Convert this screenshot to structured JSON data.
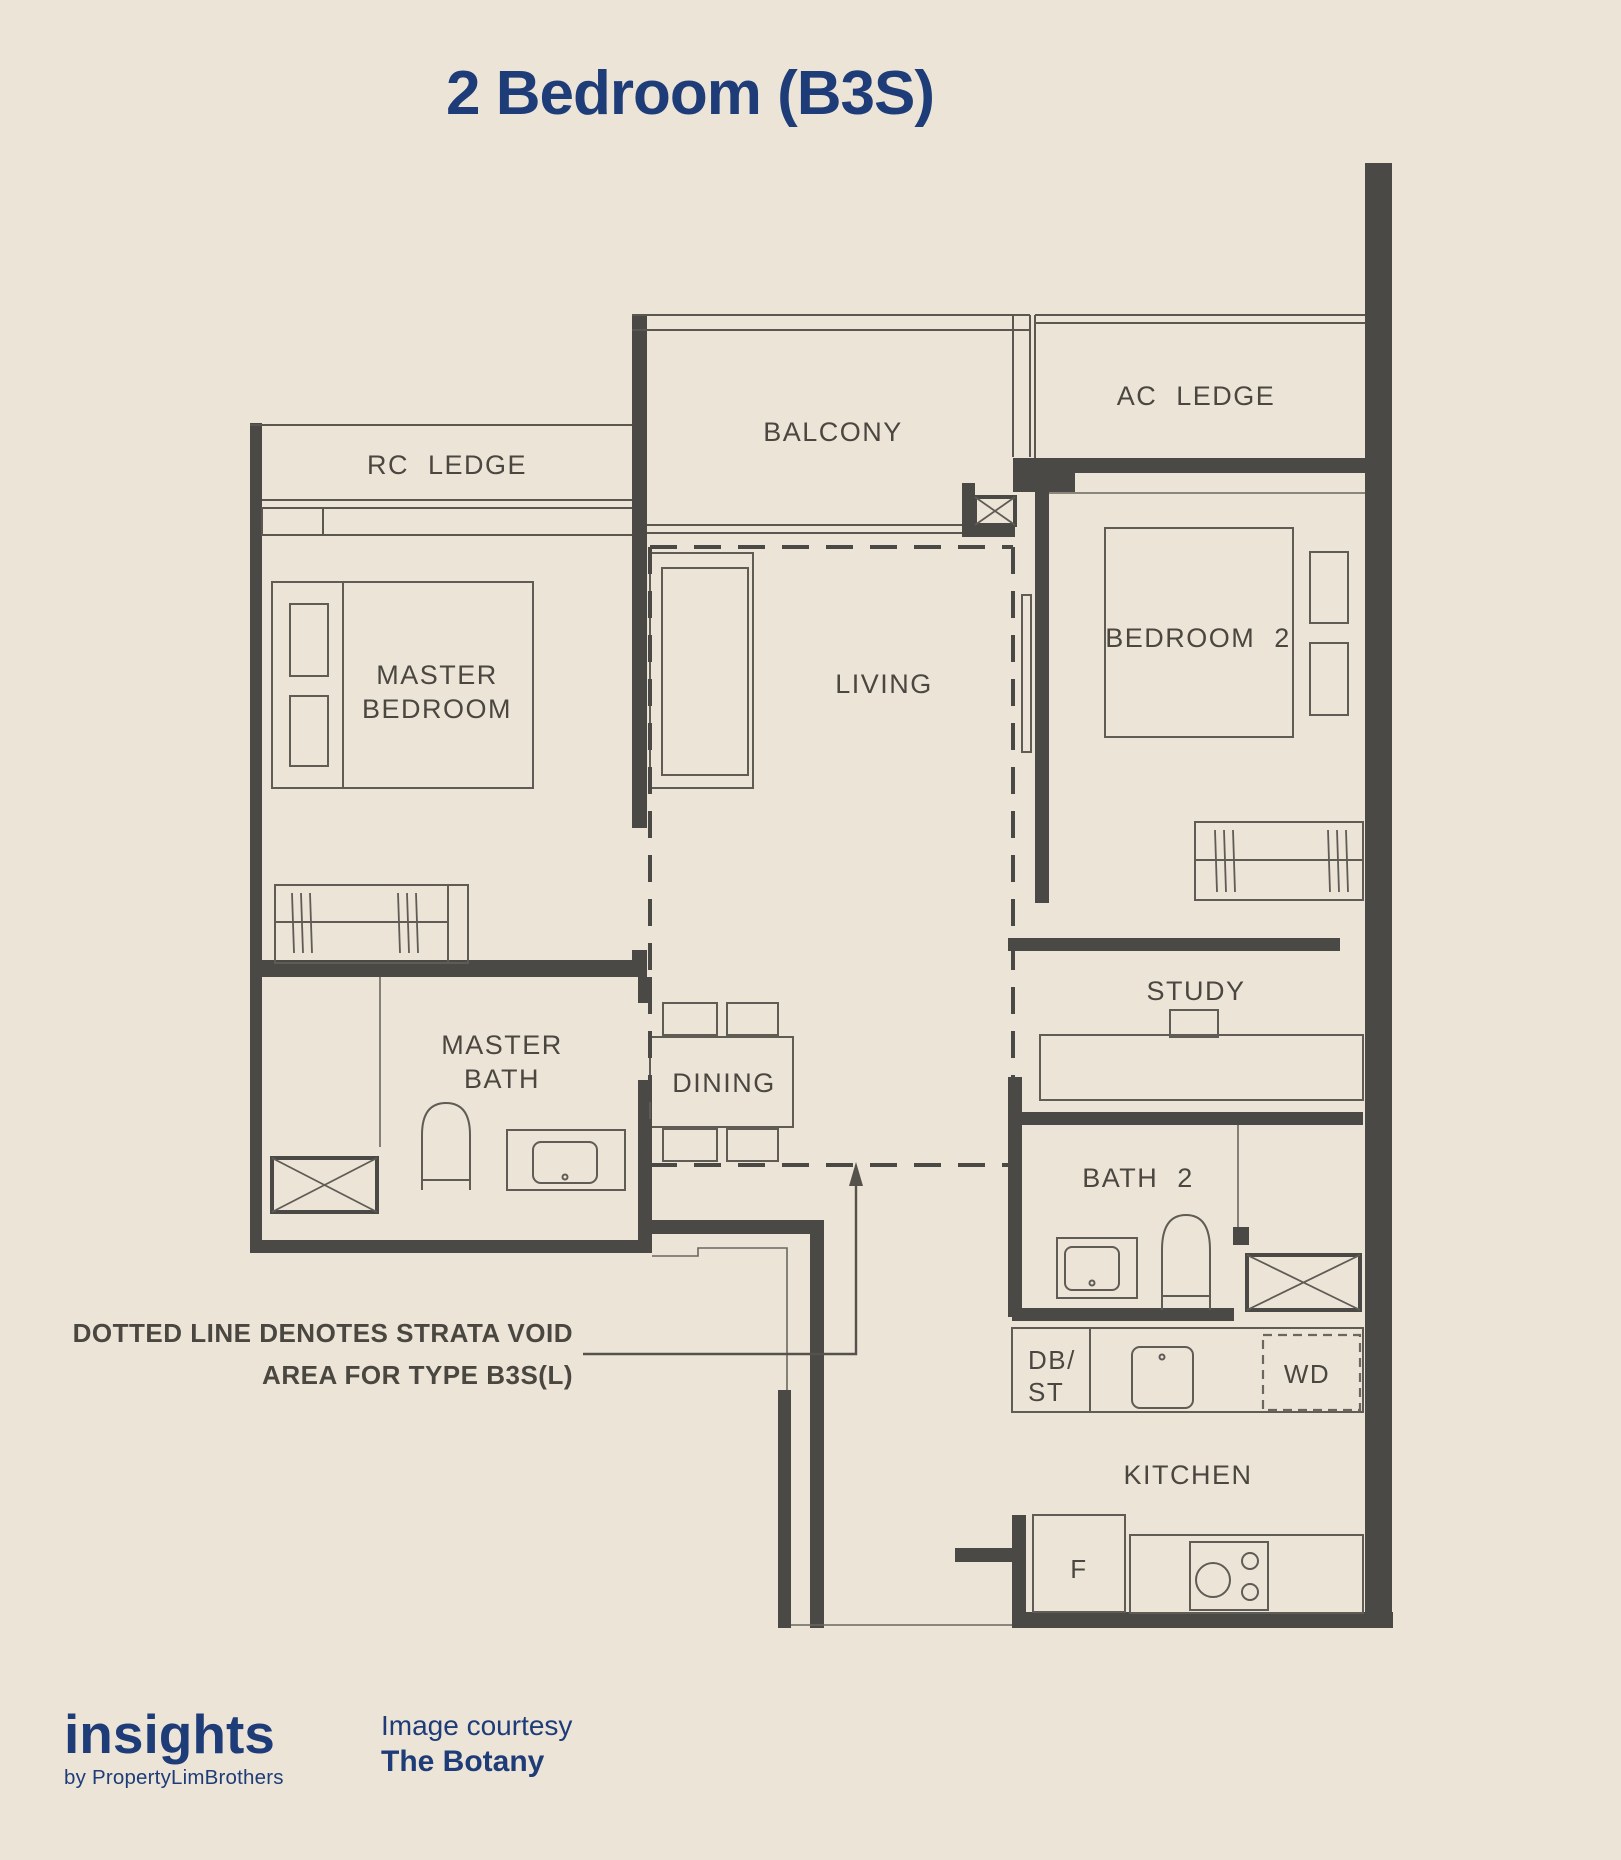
{
  "title": "2 Bedroom (B3S)",
  "plan": {
    "rooms": {
      "rc_ledge": "RC LEDGE",
      "balcony": "BALCONY",
      "ac_ledge": "AC LEDGE",
      "master_bedroom_line1": "MASTER",
      "master_bedroom_line2": "BEDROOM",
      "living": "LIVING",
      "bedroom_2": "BEDROOM 2",
      "master_bath_line1": "MASTER",
      "master_bath_line2": "BATH",
      "dining": "DINING",
      "study": "STUDY",
      "bath_2": "BATH 2",
      "kitchen": "KITCHEN"
    },
    "fixtures": {
      "db_st_line1": "DB/",
      "db_st_line2": "ST",
      "washer_dryer": "WD",
      "fridge": "F"
    },
    "annotation": {
      "line1": "DOTTED LINE DENOTES STRATA VOID",
      "line2": "AREA FOR TYPE B3S(L)"
    }
  },
  "footer": {
    "logo": "insights",
    "logo_byline": "by PropertyLimBrothers",
    "courtesy_label": "Image courtesy",
    "courtesy_name": "The Botany"
  },
  "colors": {
    "background": "#EDE4D8",
    "navy": "#1E3C78",
    "plan_line": "#4B4945"
  }
}
